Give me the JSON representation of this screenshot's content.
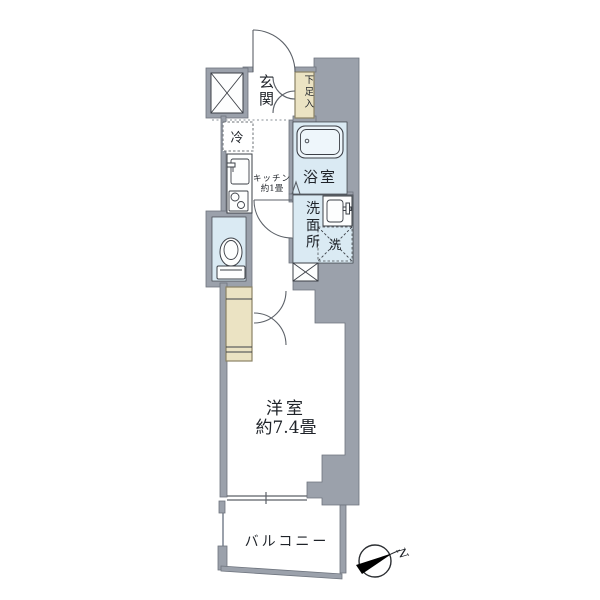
{
  "theme": {
    "bg": "#ffffff",
    "wall": "#9ba1ab",
    "wall-line": "#6e747e",
    "blue": "#daeaf3",
    "tub": "#eef6fb",
    "tan": "#ebe3c3",
    "tan-line": "#8a8264",
    "line": "#3c4047",
    "text": "#1f2329",
    "compass": "#000000"
  },
  "plan": {
    "entrance": {
      "label": "玄関"
    },
    "shoe_box": {
      "label": "下足入"
    },
    "fridge": {
      "label": "冷"
    },
    "kitchen": {
      "label": "キッチン",
      "size": "約1畳"
    },
    "bathroom": {
      "label": "浴室"
    },
    "washroom": {
      "label": "洗面所"
    },
    "washer": {
      "label": "洗"
    },
    "western_room": {
      "label": "洋室",
      "size": "約7.4畳"
    },
    "balcony": {
      "label": "バルコニー"
    },
    "compass": {
      "north": "N"
    }
  }
}
